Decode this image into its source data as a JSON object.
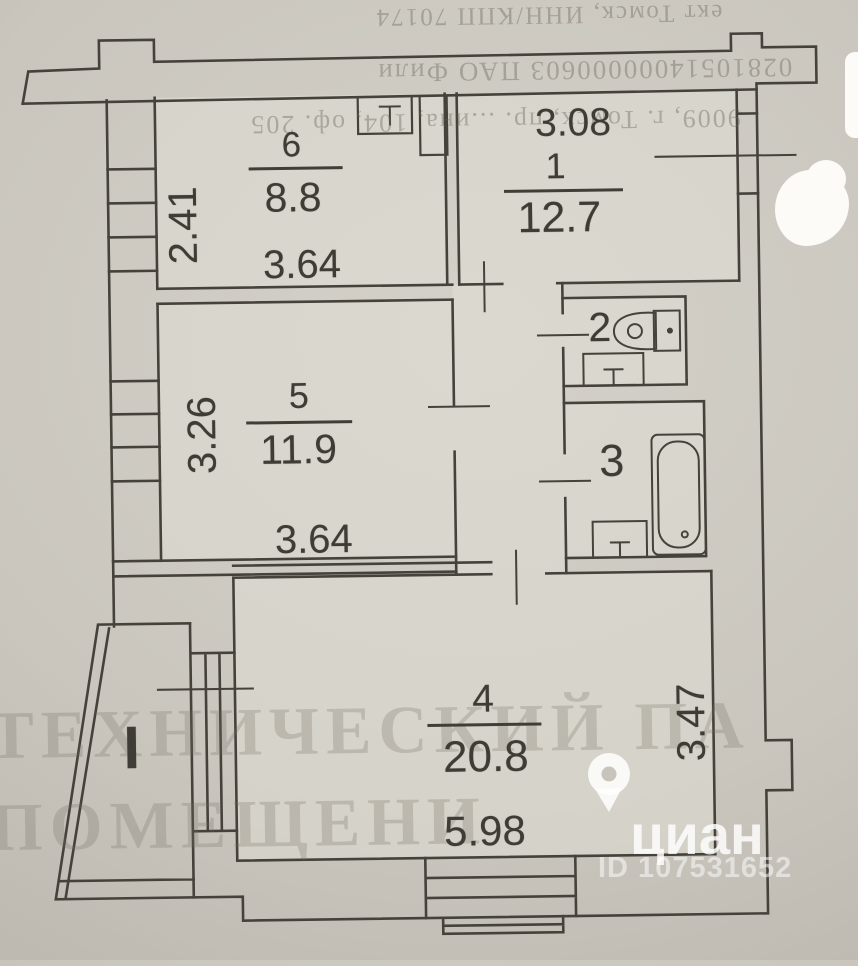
{
  "page": {
    "paper_color": "#cac6be",
    "ink_color": "#413e38"
  },
  "bleed_text": {
    "line1": "ект Томск, ИНН/КПП 70174",
    "line2": "02810514000000603 ПАО Фили",
    "line3": "9009, г. Томск, пр. ...ина, 104, оф. 205",
    "big_line1": "ТЕХНИЧЕСКИЙ ПА",
    "big_line2": "ПОМЕЩЕНИ"
  },
  "watermark": {
    "brand": "циан",
    "id_label": "ID 107531652"
  },
  "balcony": {
    "mark": "I"
  },
  "rooms": {
    "r1": {
      "number": "1",
      "area": "12.7",
      "width_dim": "3.08"
    },
    "r2": {
      "number": "2"
    },
    "r3": {
      "number": "3"
    },
    "r4": {
      "number": "4",
      "area": "20.8",
      "width_dim": "5.98",
      "height_dim": "3.47"
    },
    "r5": {
      "number": "5",
      "area": "11.9",
      "width_dim": "3.64",
      "height_dim": "3.26"
    },
    "r6": {
      "number": "6",
      "area": "8.8",
      "width_dim": "3.64",
      "height_dim": "2.41"
    }
  }
}
